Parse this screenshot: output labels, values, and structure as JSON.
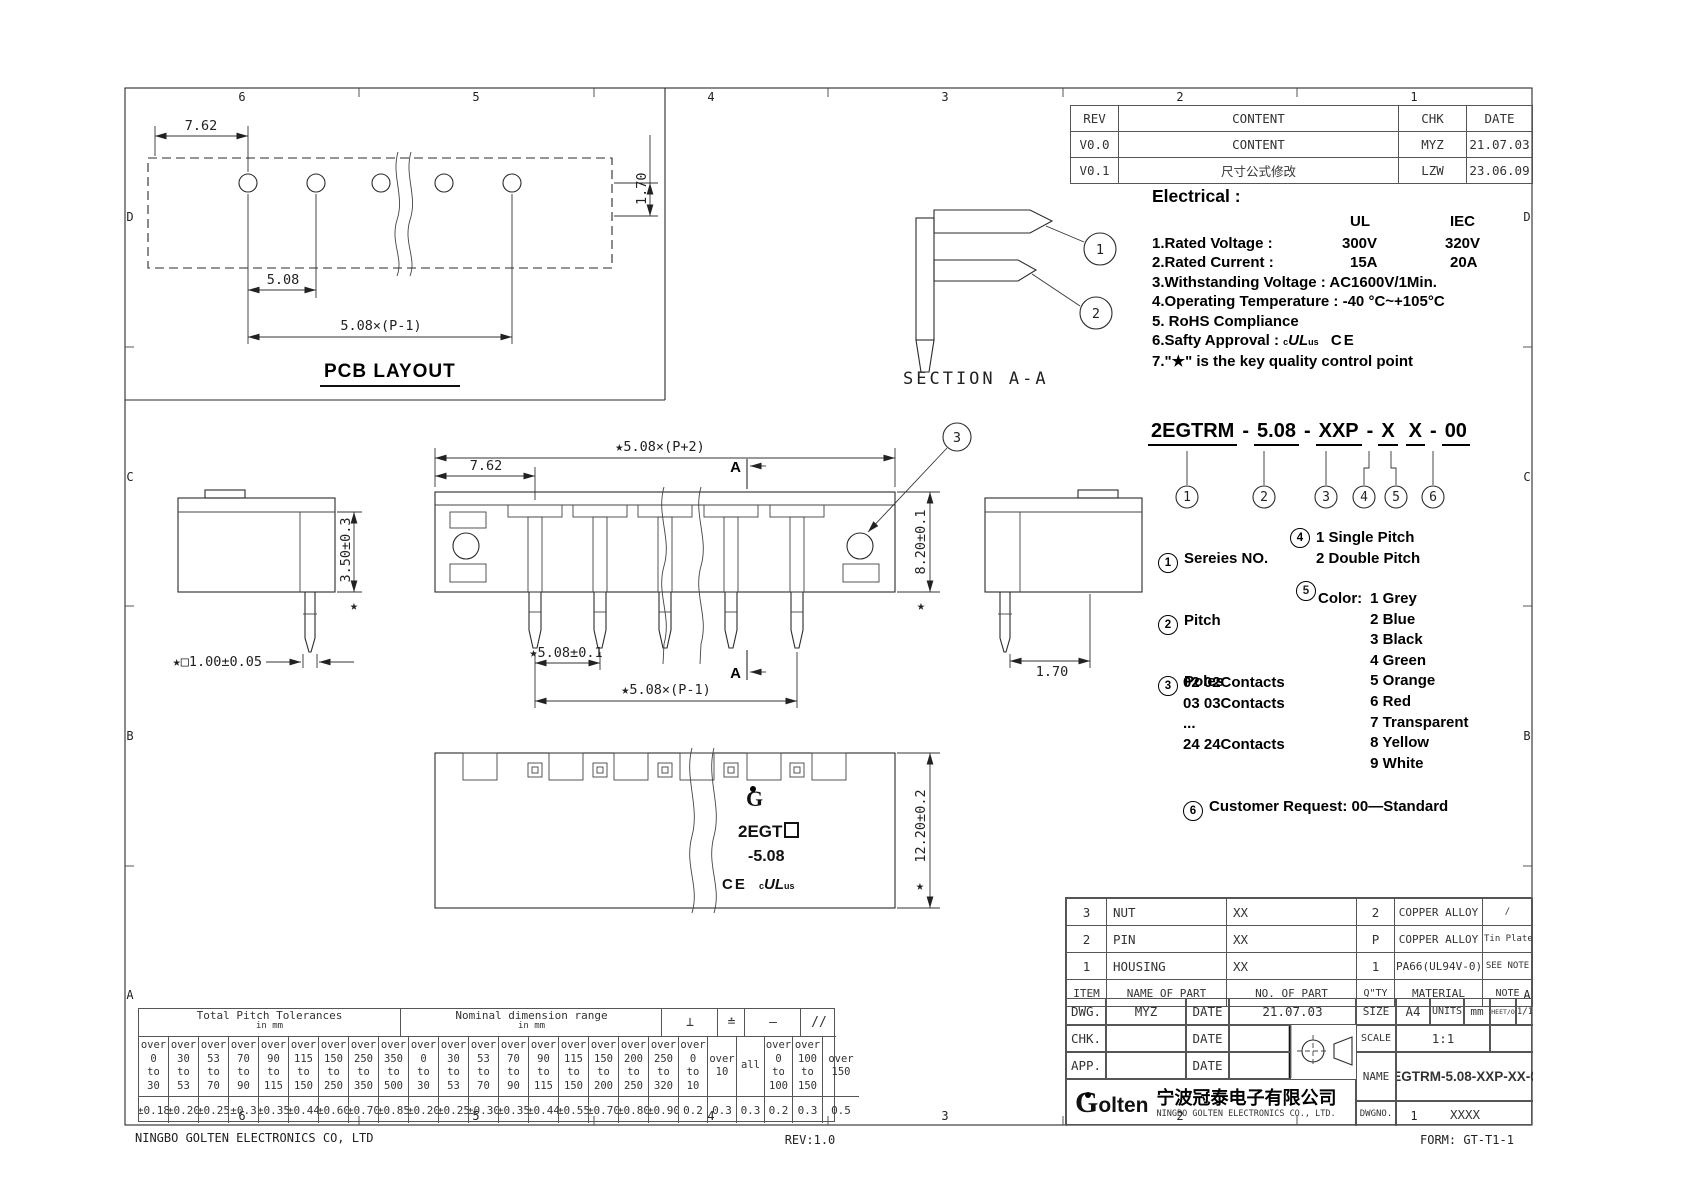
{
  "meta": {
    "footer_left": "NINGBO GOLTEN ELECTRONICS CO, LTD",
    "footer_center": "REV:1.0",
    "footer_right": "FORM: GT-T1-1"
  },
  "zones": {
    "top": [
      "6",
      "5",
      "4",
      "3",
      "2",
      "1"
    ],
    "bottom": [
      "6",
      "5",
      "4",
      "3",
      "2",
      "1"
    ],
    "left": [
      "D",
      "C",
      "B",
      "A"
    ],
    "right": [
      "D",
      "C",
      "B",
      "A"
    ]
  },
  "pcb": {
    "title": "PCB LAYOUT",
    "dim_edge": "7.62",
    "dim_pitch": "5.08",
    "dim_span": "5.08×(P-1)",
    "dim_offset": "1.70"
  },
  "revision_table": {
    "headers": [
      "REV",
      "CONTENT",
      "CHK",
      "DATE"
    ],
    "rows": [
      [
        "V0.0",
        "CONTENT",
        "MYZ",
        "21.07.03"
      ],
      [
        "V0.1",
        "尺寸公式修改",
        "LZW",
        "23.06.09"
      ]
    ]
  },
  "electrical": {
    "title": "Electrical :",
    "col_ul": "UL",
    "col_iec": "IEC",
    "rows": [
      {
        "label": "1.Rated Voltage :",
        "ul": "300V",
        "iec": "320V"
      },
      {
        "label": "2.Rated Current :",
        "ul": "15A",
        "iec": "20A"
      }
    ],
    "lines": [
      "3.Withstanding Voltage : AC1600V/1Min.",
      "4.Operating Temperature : -40 °C~+105°C",
      "5. RoHS Compliance"
    ],
    "safety_label": "6.Safty Approval :",
    "safety_c": "c",
    "safety_ul": "UL",
    "safety_us": "us",
    "safety_ce": "CE",
    "line7": "7.\"★\" is the key quality control point"
  },
  "section": {
    "label": "SECTION A-A",
    "callout1": "1",
    "callout2": "2",
    "callout3": "3"
  },
  "part_number": {
    "segments": [
      "2EGTRM",
      "5.08",
      "XXP",
      "X",
      "X",
      "00"
    ],
    "dash": "-",
    "callouts": [
      "1",
      "2",
      "3",
      "4",
      "5",
      "6"
    ]
  },
  "legend": {
    "m1": "1",
    "label1": "Sereies NO.",
    "m2": "2",
    "label2": "Pitch",
    "m3": "3",
    "label3": "Poles",
    "poles": [
      "02   02Contacts",
      "03   03Contacts",
      "...",
      "24   24Contacts"
    ],
    "m4": "4",
    "pitch_types": [
      "1  Single Pitch",
      "2  Double Pitch"
    ],
    "m5": "5",
    "color_label": "Color:",
    "colors": [
      "1 Grey",
      "2 Blue",
      "3 Black",
      "4 Green",
      "5 Orange",
      "6 Red",
      "7 Transparent",
      "8 Yellow",
      "9 White"
    ],
    "m6": "6",
    "label6": "Customer Request: 00—Standard"
  },
  "dims": {
    "front_overall": "★5.08×(P+2)",
    "front_edge": "7.62",
    "front_height": "8.20±0.1",
    "front_pitch": "★5.08±0.1",
    "front_span": "★5.08×(P-1)",
    "side_height": "3.50±0.3",
    "pin_square": "★□1.00±0.05",
    "right_offset": "1.70",
    "bottom_height": "12.20±0.2",
    "star": "★",
    "section_arrow": "A"
  },
  "markings": {
    "logo": "G",
    "line1": "2EGT",
    "line2": "-5.08",
    "ce": "CE",
    "ul_c": "c",
    "ul": "UL",
    "ul_us": "us"
  },
  "bom": {
    "headers": {
      "item": "ITEM",
      "name": "NAME OF PART",
      "no": "NO. OF PART",
      "qty": "Q\"TY",
      "material": "MATERIAL",
      "note": "NOTE"
    },
    "parts": [
      {
        "item": "3",
        "name": "NUT",
        "no": "XX",
        "qty": "2",
        "material": "COPPER ALLOY",
        "note": "/"
      },
      {
        "item": "2",
        "name": "PIN",
        "no": "XX",
        "qty": "P",
        "material": "COPPER ALLOY",
        "note": "Tin Plated"
      },
      {
        "item": "1",
        "name": "HOUSING",
        "no": "XX",
        "qty": "1",
        "material": "PA66(UL94V-0)",
        "note": "SEE NOTE"
      }
    ],
    "admin": {
      "dwg": "DWG.",
      "dwg_by": "MYZ",
      "date": "DATE",
      "dwg_date": "21.07.03",
      "chk": "CHK.",
      "app": "APP.",
      "size_label": "SIZE",
      "size": "A4",
      "units_label": "UNITS",
      "units": "mm",
      "sheet_label": "SHEET/OF",
      "sheet": "1/1",
      "scale_label": "SCALE",
      "scale": "1:1"
    },
    "company": {
      "logo_g": "G",
      "logo_rest": "olten",
      "cn": "宁波冠泰电子有限公司",
      "en": "NINGBO GOLTEN ELECTRONICS CO., LTD."
    },
    "name_label": "NAME",
    "name": "2EGTRM-5.08-XXP-XX-00",
    "dwgno_label": "DWGNO.",
    "dwgno": "XXXX"
  },
  "tolerance_table": {
    "group1": {
      "title": "Total Pitch Tolerances",
      "sub": "in mm",
      "cols": [
        {
          "lines": [
            "over",
            "0",
            "to",
            "30"
          ],
          "tol": "±0.18"
        },
        {
          "lines": [
            "over",
            "30",
            "to",
            "53"
          ],
          "tol": "±0.20"
        },
        {
          "lines": [
            "over",
            "53",
            "to",
            "70"
          ],
          "tol": "±0.25"
        },
        {
          "lines": [
            "over",
            "70",
            "to",
            "90"
          ],
          "tol": "±0.3"
        },
        {
          "lines": [
            "over",
            "90",
            "to",
            "115"
          ],
          "tol": "±0.35"
        },
        {
          "lines": [
            "over",
            "115",
            "to",
            "150"
          ],
          "tol": "±0.44"
        },
        {
          "lines": [
            "over",
            "150",
            "to",
            "250"
          ],
          "tol": "±0.60"
        },
        {
          "lines": [
            "over",
            "250",
            "to",
            "350"
          ],
          "tol": "±0.70"
        },
        {
          "lines": [
            "over",
            "350",
            "to",
            "500"
          ],
          "tol": "±0.85"
        }
      ]
    },
    "group2": {
      "title": "Nominal dimension range",
      "sub": "in mm",
      "cols": [
        {
          "lines": [
            "over",
            "0",
            "to",
            "30"
          ],
          "tol": "±0.20"
        },
        {
          "lines": [
            "over",
            "30",
            "to",
            "53"
          ],
          "tol": "±0.25"
        },
        {
          "lines": [
            "over",
            "53",
            "to",
            "70"
          ],
          "tol": "±0.30"
        },
        {
          "lines": [
            "over",
            "70",
            "to",
            "90"
          ],
          "tol": "±0.35"
        },
        {
          "lines": [
            "over",
            "90",
            "to",
            "115"
          ],
          "tol": "±0.44"
        },
        {
          "lines": [
            "over",
            "115",
            "to",
            "150"
          ],
          "tol": "±0.55"
        },
        {
          "lines": [
            "over",
            "150",
            "to",
            "200"
          ],
          "tol": "±0.70"
        },
        {
          "lines": [
            "over",
            "200",
            "to",
            "250"
          ],
          "tol": "±0.80"
        },
        {
          "lines": [
            "over",
            "250",
            "to",
            "320"
          ],
          "tol": "±0.90"
        }
      ]
    },
    "geo": {
      "symbols": [
        "⊥",
        "≐",
        "—",
        "//"
      ],
      "cols": [
        {
          "lines": [
            "over",
            "0",
            "to",
            "10"
          ],
          "tol": "0.2"
        },
        {
          "lines": [
            "over",
            "10"
          ],
          "tol": "0.3"
        },
        {
          "lines": [
            "all"
          ],
          "tol": "0.3"
        },
        {
          "lines": [
            "over",
            "0",
            "to",
            "100"
          ],
          "tol": "0.2"
        },
        {
          "lines": [
            "over",
            "100",
            "to",
            "150"
          ],
          "tol": "0.3"
        },
        {
          "lines": [
            "over",
            "150"
          ],
          "tol": "0.5"
        }
      ]
    }
  }
}
